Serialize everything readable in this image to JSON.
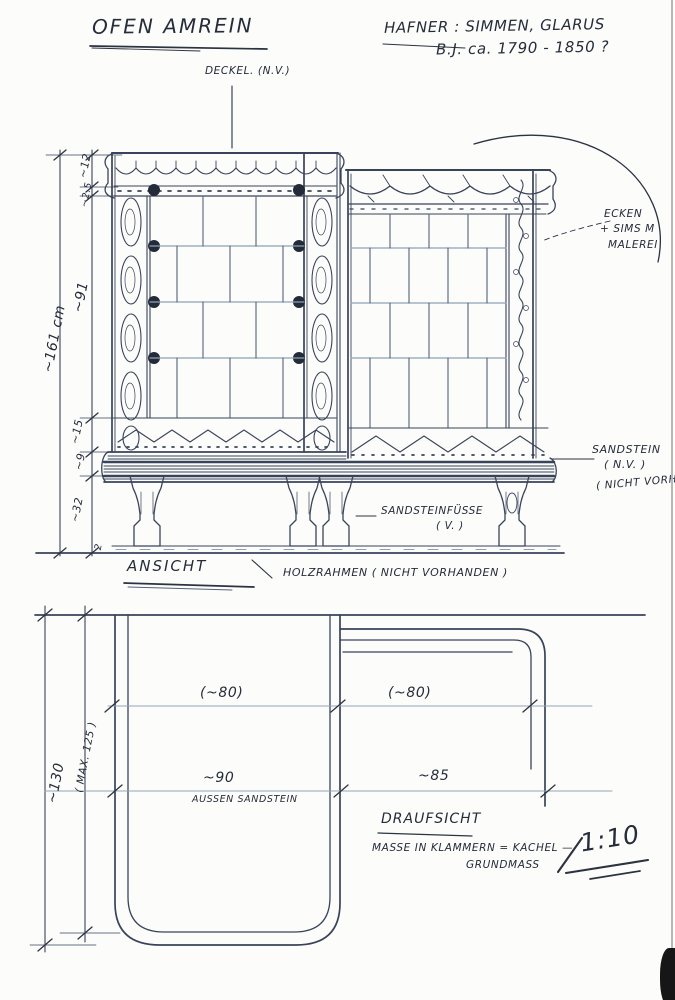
{
  "header": {
    "title": "OFEN AMREIN",
    "maker_line": "HAFNER : SIMMEN, GLARUS",
    "date_line": "B.J. ca. 1790 - 1850 ?"
  },
  "elevation": {
    "view_label": "ANSICHT",
    "deckel_label": "DECKEL. (N.V.)",
    "ecken_label_1": "ECKEN",
    "ecken_label_2": "+ SIMS M",
    "ecken_label_3": "MALEREI",
    "sandstein_label_1": "SANDSTEIN",
    "sandstein_label_2": "( N.V. )",
    "sandstein_label_3": "( NICHT VORHAN",
    "fuesse_label_1": "SANDSTEINFÜSSE",
    "fuesse_label_2": "( V. )",
    "holzrahmen_label": "HOLZRAHMEN ( NICHT VORHANDEN )",
    "dims": {
      "d_top": "~12",
      "d_top2": "~2.5",
      "d_body": "~91",
      "d_total": "~161 cm",
      "d_frieze": "~15",
      "d_base": "~9",
      "d_feet": "~32",
      "d_frame": "2"
    }
  },
  "plan": {
    "view_label": "DRAUFSICHT",
    "dim_tile_left": "(~80)",
    "dim_tile_right": "(~80)",
    "dim_width_left": "~90",
    "dim_width_right": "~85",
    "dim_depth": "~130",
    "dim_depth_max": "( MAX. 125 )",
    "material_label": "AUSSEN SANDSTEIN",
    "note_line_1": "MASSE IN KLAMMERN = KACHEL —",
    "note_line_2": "GRUNDMASS",
    "scale_label": "1:10"
  },
  "colors": {
    "ink": "#39435a",
    "text": "#252c3a",
    "tile_line": "#8ea1b8"
  }
}
